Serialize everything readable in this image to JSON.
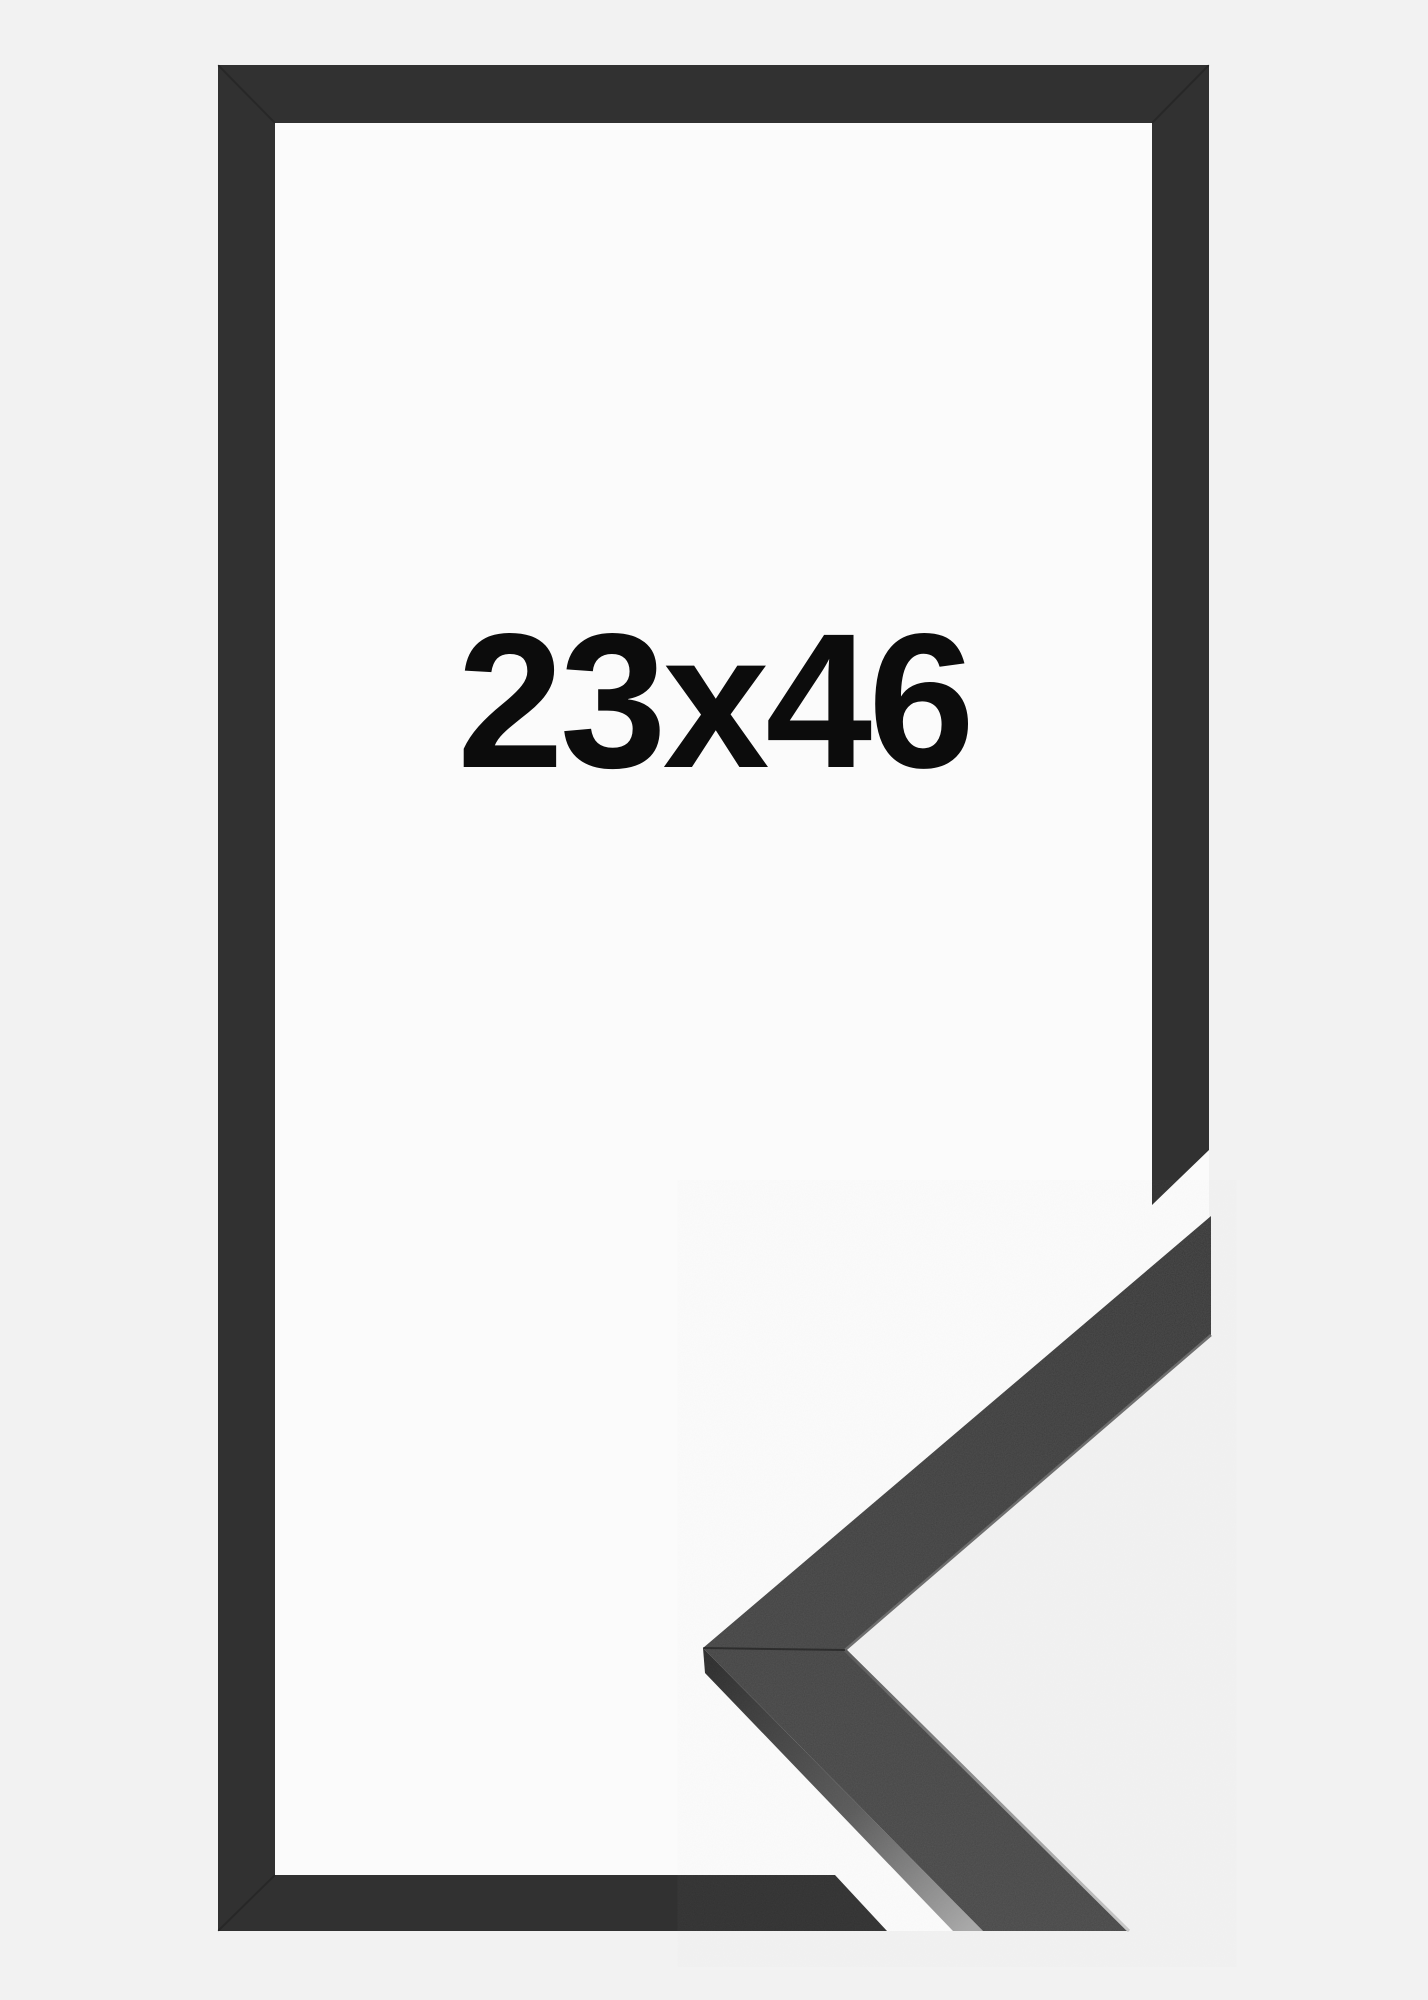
{
  "image": {
    "description_label": "picture-frame-size-product-image",
    "size_label": "23x46",
    "colors": {
      "background": "#f2f2f2",
      "interior": "#fbfbfb",
      "frame": "#313131",
      "profile_face": "#3d3d3d",
      "text": "#0c0c0c"
    }
  }
}
